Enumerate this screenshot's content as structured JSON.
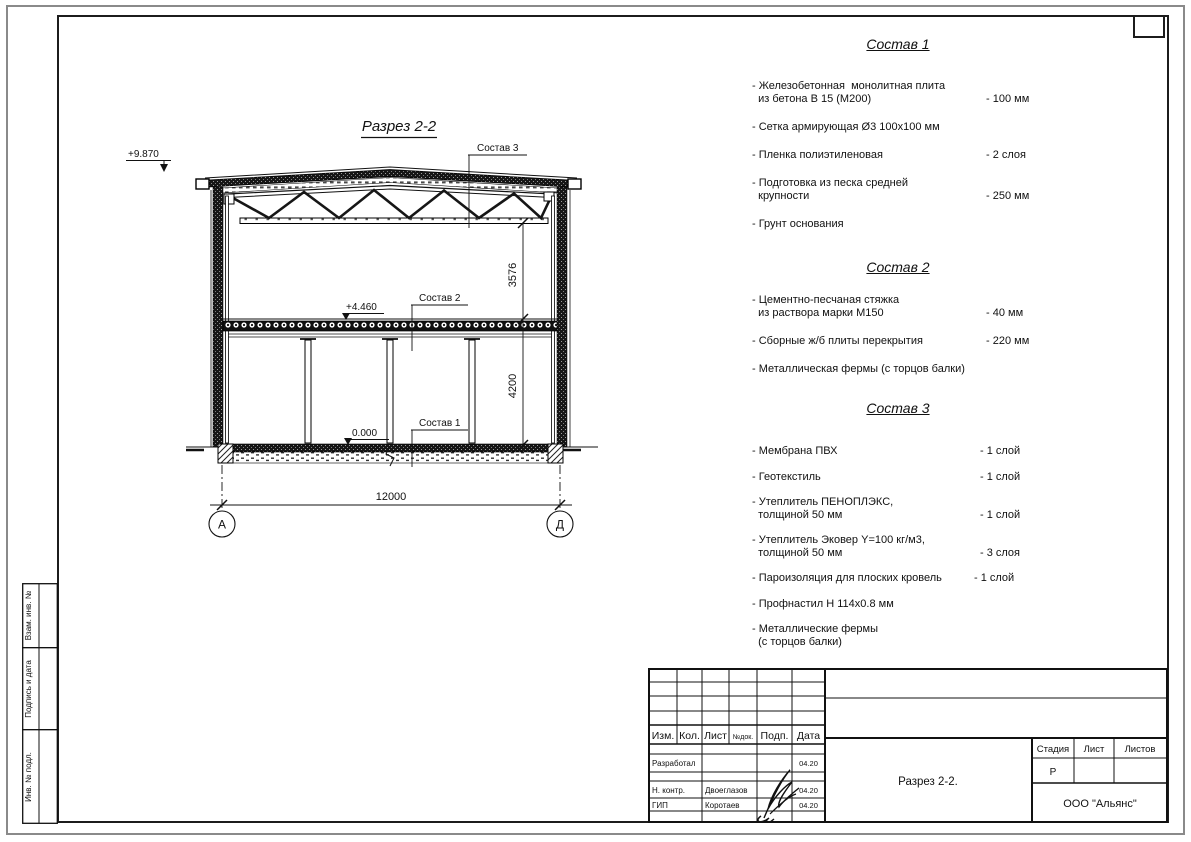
{
  "sheet": {
    "drawing": {
      "title": "Разрез 2-2",
      "elevations": {
        "roof": "+9.870",
        "floor": "+4.460",
        "zero": "0.000"
      },
      "callouts": {
        "c3": "Состав 3",
        "c2": "Состав 2",
        "c1": "Состав 1"
      },
      "dimensions": {
        "upper": "3576",
        "lower": "4200",
        "span": "12000"
      },
      "axes": {
        "left": "А",
        "right": "Д"
      }
    },
    "compositions": [
      {
        "title": "Состав 1",
        "items": [
          {
            "name": "- Железобетонная  монолитная плита\n  из бетона В 15 (М200)",
            "value": "- 100 мм"
          },
          {
            "name": "- Сетка армирующая Ø3 100х100 мм",
            "value": ""
          },
          {
            "name": "- Пленка полиэтиленовая",
            "value": "- 2 слоя"
          },
          {
            "name": "- Подготовка из песка средней\n  крупности",
            "value": "- 250 мм"
          },
          {
            "name": "- Грунт основания",
            "value": ""
          }
        ]
      },
      {
        "title": "Состав 2",
        "items": [
          {
            "name": "- Цементно-песчаная стяжка\n  из раствора марки М150",
            "value": "- 40 мм"
          },
          {
            "name": "- Сборные ж/б плиты перекрытия",
            "value": "- 220 мм"
          },
          {
            "name": "- Металлическая фермы (с торцов балки)",
            "value": ""
          }
        ]
      },
      {
        "title": "Состав 3",
        "items": [
          {
            "name": "- Мембрана ПВХ",
            "value": "- 1 слой"
          },
          {
            "name": "- Геотекстиль",
            "value": "- 1 слой"
          },
          {
            "name": "- Утеплитель ПЕНОПЛЭКС,\n  толщиной 50 мм",
            "value": "- 1 слой"
          },
          {
            "name": "- Утеплитель Эковер Y=100 кг/м3,\n  толщиной 50 мм",
            "value": "- 3 слоя"
          },
          {
            "name": "- Пароизоляция для плоских кровель",
            "value": "- 1 слой"
          },
          {
            "name": "- Профнастил Н 114х0.8 мм",
            "value": ""
          },
          {
            "name": "- Металлические фермы\n  (с торцов балки)",
            "value": ""
          }
        ]
      }
    ],
    "sidebar": {
      "labels": [
        "Взам. инв. №",
        "Подпись и дата",
        "Инв. № подл."
      ]
    },
    "titleblock": {
      "header": {
        "izm": "Изм.",
        "kol": "Кол.",
        "list": "Лист",
        "ndok": "№док.",
        "podp": "Подп.",
        "data": "Дата"
      },
      "rows": [
        {
          "role": "Разработал",
          "name": "",
          "date": "04.20"
        },
        {
          "role": "Н. контр.",
          "name": "Двоеглазов",
          "date": "04.20"
        },
        {
          "role": "ГИП",
          "name": "Коротаев",
          "date": "04.20"
        }
      ],
      "doc_title": "Разрез 2-2.",
      "company": "ООО \"Альянс\"",
      "stage": {
        "label": "Стадия",
        "sheet": "Лист",
        "sheets": "Листов",
        "value": "Р"
      }
    }
  }
}
